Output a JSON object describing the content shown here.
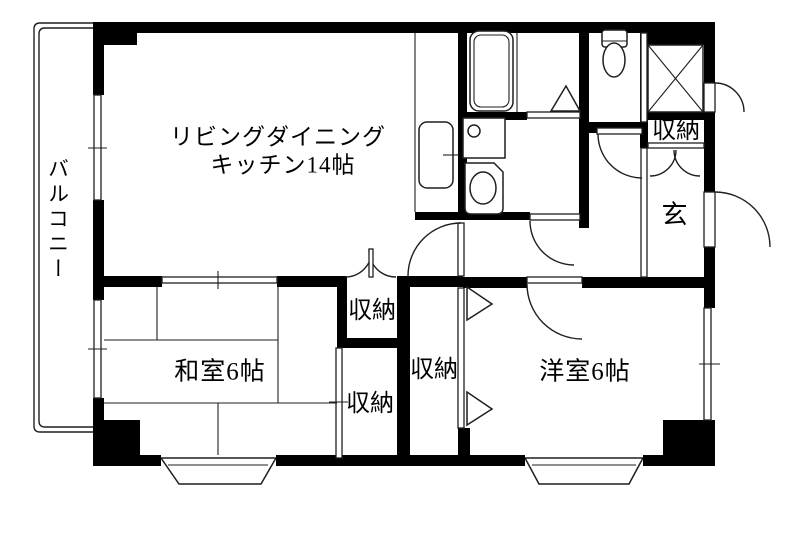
{
  "colors": {
    "wall": "#000000",
    "line": "#1f1f1f",
    "bg": "#ffffff"
  },
  "rooms": {
    "balcony": {
      "label": "バルコニー"
    },
    "ldk": {
      "label_line1": "リビングダイニング",
      "label_line2": "キッチン14帖"
    },
    "japanese_room": {
      "label": "和室6帖"
    },
    "western_room": {
      "label": "洋室6帖"
    },
    "entrance": {
      "label": "玄"
    }
  },
  "closets": {
    "ldk_side": {
      "label": "収納"
    },
    "japanese_side": {
      "label": "収納"
    },
    "hall_side": {
      "label": "収納"
    },
    "entrance_side": {
      "label": "収納"
    }
  }
}
